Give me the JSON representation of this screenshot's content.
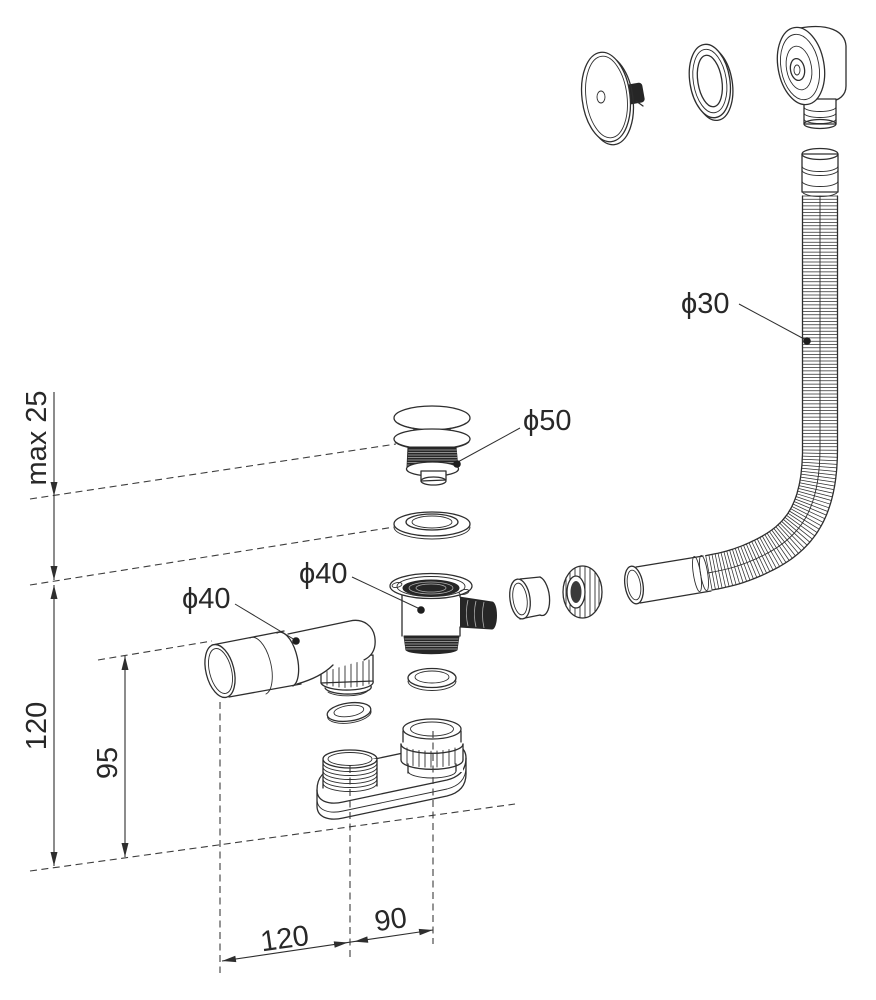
{
  "labels": {
    "hose_diameter": "ϕ30",
    "plug_diameter": "ϕ50",
    "tee_diameter": "ϕ40",
    "elbow_diameter": "ϕ40",
    "max_thickness": "max 25",
    "overall_height": "120",
    "elbow_height": "95",
    "spacing_left": "120",
    "spacing_right": "90"
  },
  "colors": {
    "line": "#2e2e2e",
    "dark_fill": "#262626",
    "background": "#ffffff"
  }
}
